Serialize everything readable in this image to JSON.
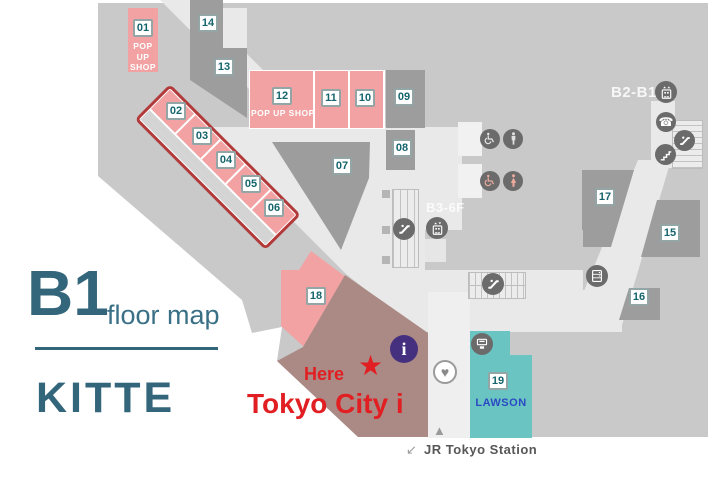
{
  "branding": {
    "floor": "B1",
    "subtitle": "floor map",
    "building": "KITTE"
  },
  "marker": {
    "here": "Here",
    "star": "★",
    "name": "Tokyo City i"
  },
  "station": {
    "arrow": "↙",
    "label": "JR Tokyo Station",
    "triangle": "▲"
  },
  "wayfinding": {
    "b2_b1": "B2-B1",
    "b3_6f": "B3-6F"
  },
  "shops": {
    "lawson": "LAWSON",
    "popup_01": "POP UP SHOP",
    "popup_12": "POP UP SHOP"
  },
  "units": {
    "u01": "01",
    "u02": "02",
    "u03": "03",
    "u04": "04",
    "u05": "05",
    "u06": "06",
    "u07": "07",
    "u08": "08",
    "u09": "09",
    "u10": "10",
    "u11": "11",
    "u12": "12",
    "u13": "13",
    "u14": "14",
    "u15": "15",
    "u16": "16",
    "u17": "17",
    "u18": "18",
    "u19": "19"
  },
  "icons": {
    "phone": "☎",
    "heart": "♥",
    "info": "i"
  },
  "colors": {
    "base_gray": "#c9c9c9",
    "corridor": "#e9e9e9",
    "unit_gray": "#9d9d9d",
    "pink": "#f2a2a2",
    "highlight_outline": "#b23a3a",
    "brown": "#ab8a85",
    "teal_block": "#6ac5c2",
    "lawson_blue": "#2b49c3",
    "red": "#e11f23",
    "brand_teal": "#33657b",
    "label_teal": "#15656d",
    "info_purple": "#44307f",
    "icon_gray": "#6b6b6b"
  }
}
